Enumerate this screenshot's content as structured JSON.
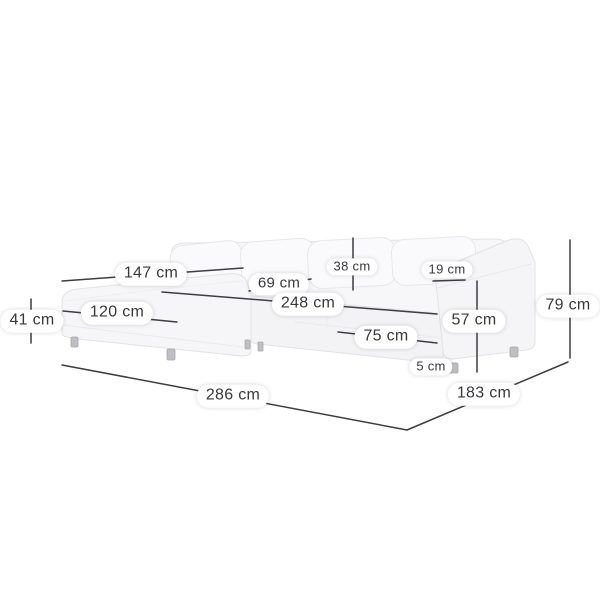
{
  "diagram": {
    "kind": "corner-sofa-dimension-diagram",
    "unit": "cm",
    "dimensions": [
      {
        "id": "left-section-width",
        "label": "147 cm"
      },
      {
        "id": "seat-cushion-depth",
        "label": "69 cm"
      },
      {
        "id": "inner-seat-width",
        "label": "248 cm"
      },
      {
        "id": "back-cushion-height",
        "label": "38 cm"
      },
      {
        "id": "armrest-width",
        "label": "19 cm"
      },
      {
        "id": "chaise-length",
        "label": "120 cm"
      },
      {
        "id": "seat-height",
        "label": "41 cm"
      },
      {
        "id": "front-height",
        "label": "75 cm"
      },
      {
        "id": "armrest-height",
        "label": "57 cm"
      },
      {
        "id": "leg-height",
        "label": "5 cm"
      },
      {
        "id": "total-width",
        "label": "286 cm"
      },
      {
        "id": "total-depth",
        "label": "183 cm"
      },
      {
        "id": "total-height",
        "label": "79 cm"
      }
    ],
    "colors": {
      "dimension_line": "#3d3d42",
      "label_text": "#38383d",
      "label_background": "#ffffff",
      "sofa_fill": "#f6f6f8",
      "sofa_edge": "#e2e2e4",
      "leg": "#bfbfc3"
    }
  }
}
